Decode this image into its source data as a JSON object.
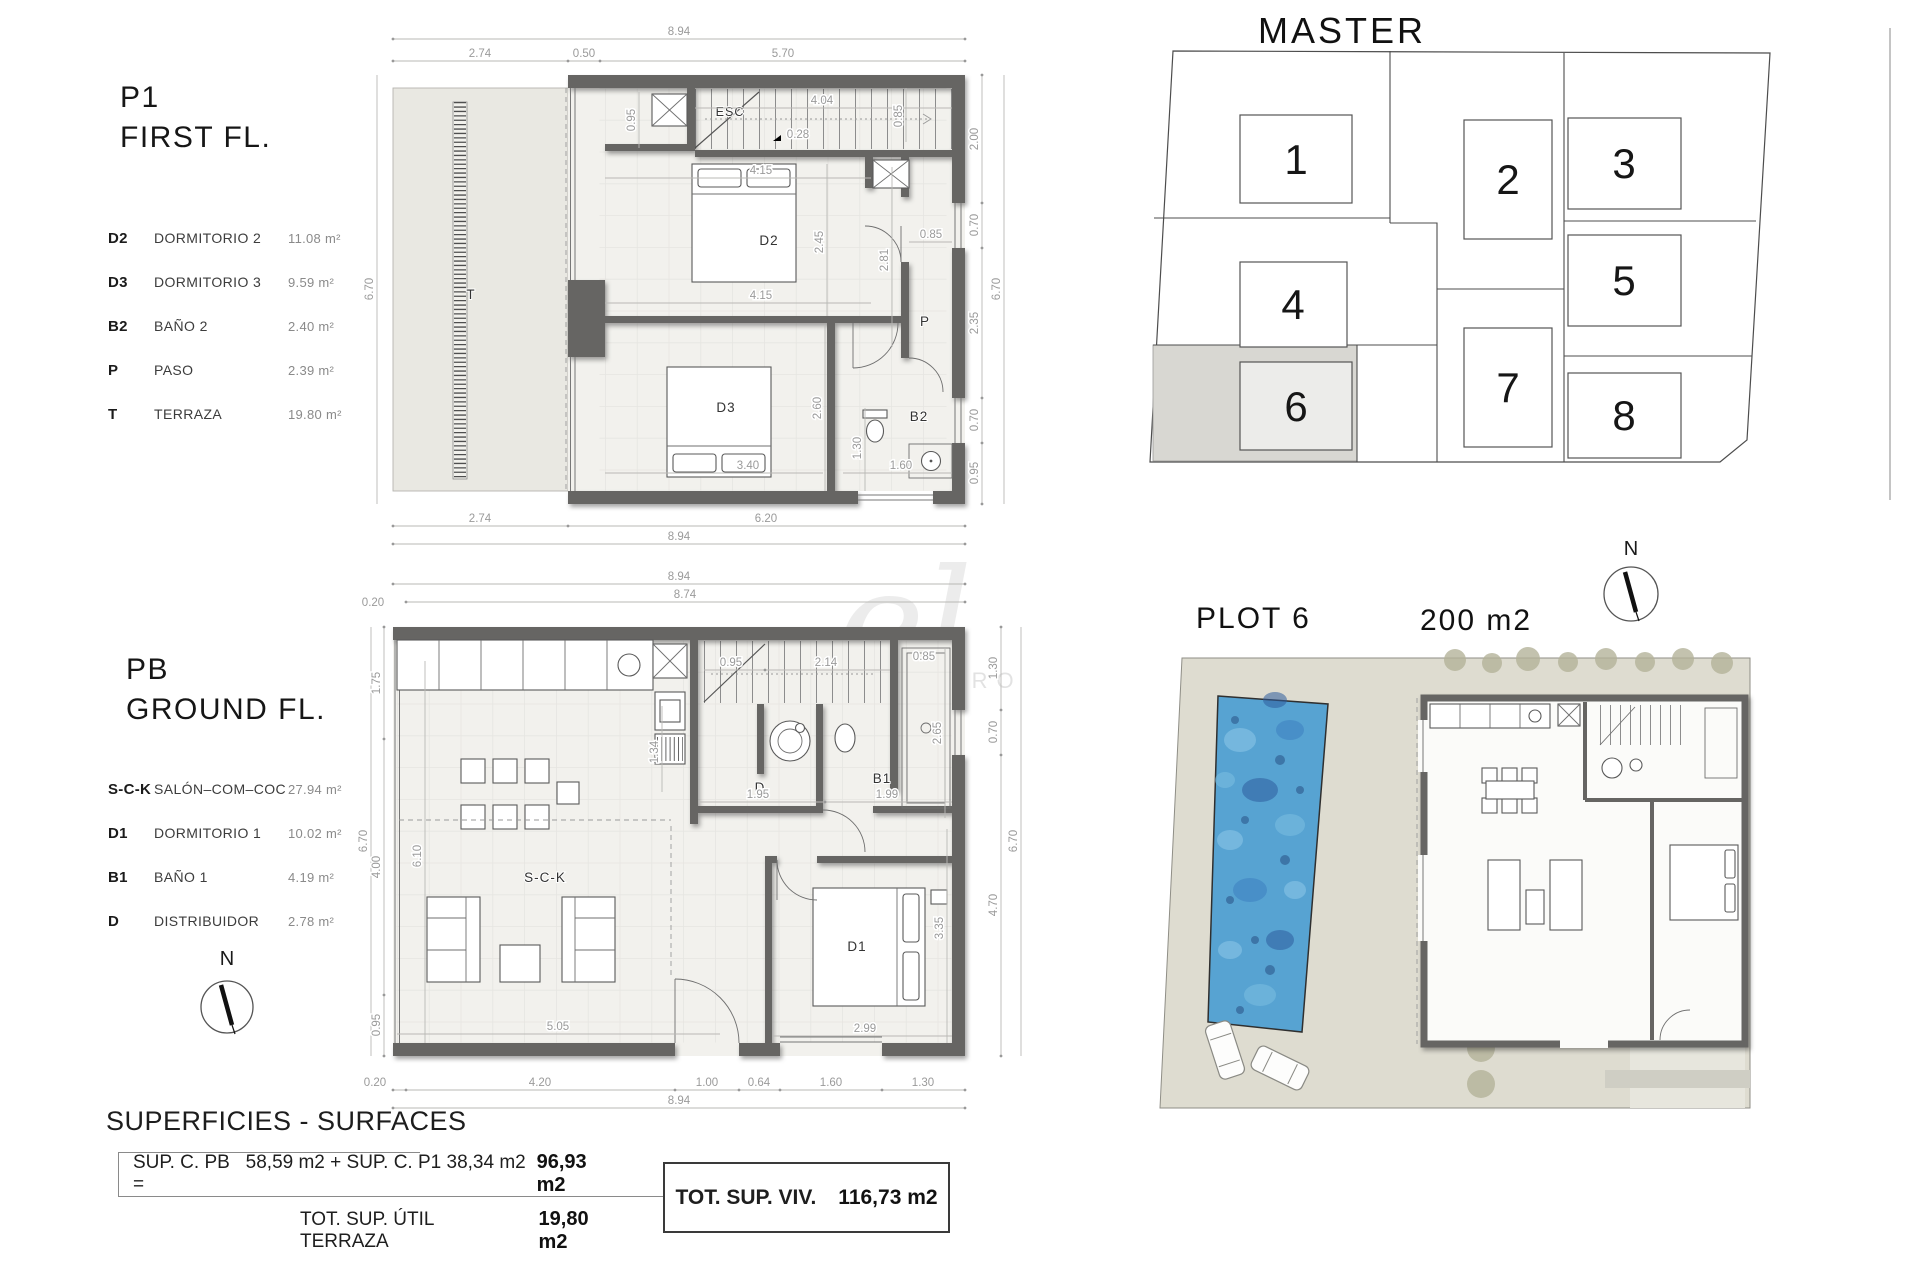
{
  "first_floor": {
    "code": "P1",
    "title": "FIRST FL.",
    "legend": [
      {
        "abbr": "D2",
        "name": "DORMITORIO  2",
        "area": "11.08  m²"
      },
      {
        "abbr": "D3",
        "name": "DORMITORIO  3",
        "area": "9.59  m²"
      },
      {
        "abbr": "B2",
        "name": "BAÑO  2",
        "area": "2.40  m²"
      },
      {
        "abbr": "P",
        "name": "PASO",
        "area": "2.39  m²"
      },
      {
        "abbr": "T",
        "name": "TERRAZA",
        "area": "19.80  m²"
      }
    ],
    "labels": {
      "esc": "ESC",
      "d2": "D2",
      "d3": "D3",
      "b2": "B2",
      "p": "P",
      "t": "T"
    },
    "dims": {
      "top_total": "8.94",
      "top_a": "2.74",
      "top_b": "0.50",
      "top_c": "5.70",
      "left_total": "6.70",
      "right_a": "2.00",
      "right_b": "0.70",
      "right_c": "2.35",
      "right_d": "0.70",
      "right_e": "0.95",
      "right_total": "6.70",
      "bottom_a": "2.74",
      "bottom_b": "6.20",
      "bottom_total": "8.94",
      "stair_h": "0.95",
      "stair_w": "4.04",
      "stair_step": "0.28",
      "d2_w": "4.15",
      "d2_h": "2.45",
      "d2_r": "0.85",
      "mid_w": "4.15",
      "p_h": "2.81",
      "p_w": "0.85",
      "d3_w": "3.40",
      "d3_h": "2.60",
      "b2_w": "1.60",
      "b2_h": "1.30"
    }
  },
  "ground_floor": {
    "code": "PB",
    "title": "GROUND FL.",
    "legend": [
      {
        "abbr": "S-C-K",
        "name": "SALÓN–COM–COC",
        "area": "27.94  m²"
      },
      {
        "abbr": "D1",
        "name": "DORMITORIO  1",
        "area": "10.02  m²"
      },
      {
        "abbr": "B1",
        "name": "BAÑO  1",
        "area": "4.19  m²"
      },
      {
        "abbr": "D",
        "name": "DISTRIBUIDOR",
        "area": "2.78  m²"
      }
    ],
    "labels": {
      "sck": "S-C-K",
      "d1": "D1",
      "b1": "B1",
      "d": "D"
    },
    "dims": {
      "top_total": "8.94",
      "top_inner": "8.74",
      "top_offset": "0.20",
      "left_a": "1.75",
      "left_b": "4.00",
      "left_c": "0.95",
      "left_total": "6.70",
      "sck_h": "6.10",
      "right_d": "1.30",
      "right_b": "0.70",
      "right_c": "4.70",
      "right_total": "6.70",
      "bath_h": "2.65",
      "shower_w": "0.85",
      "stair_a": "0.95",
      "stair_b": "2.14",
      "d_w": "1.95",
      "b1_w": "1.99",
      "d_h": "1.34",
      "sofa_w": "5.05",
      "d1_w": "2.99",
      "d1_h": "3.35",
      "bottom_offset": "0.20",
      "bottom_a": "4.20",
      "bottom_b": "1.00",
      "bottom_c": "0.64",
      "bottom_d": "1.60",
      "bottom_e": "1.30",
      "bottom_total": "8.94"
    }
  },
  "master_plan": {
    "title": "MASTER PLAN",
    "plots": [
      "1",
      "2",
      "3",
      "4",
      "5",
      "6",
      "7",
      "8"
    ]
  },
  "plot6": {
    "title": "PLOT 6",
    "area": "200 m2"
  },
  "north": "N",
  "surfaces": {
    "heading": "SUPERFICIES - SURFACES",
    "line1_label_a": "SUP. C. PB",
    "line1_label_b": "58,59 m2 + SUP. C. P1 38,34 m2 =",
    "line1_value": "96,93 m2",
    "line2_label": "TOT. SUP. ÚTIL TERRAZA",
    "line2_value": "19,80 m2",
    "total_label": "TOT. SUP. VIV.",
    "total_value": "116,73 m2"
  },
  "watermark": {
    "script": "el",
    "caption": "PRO"
  }
}
